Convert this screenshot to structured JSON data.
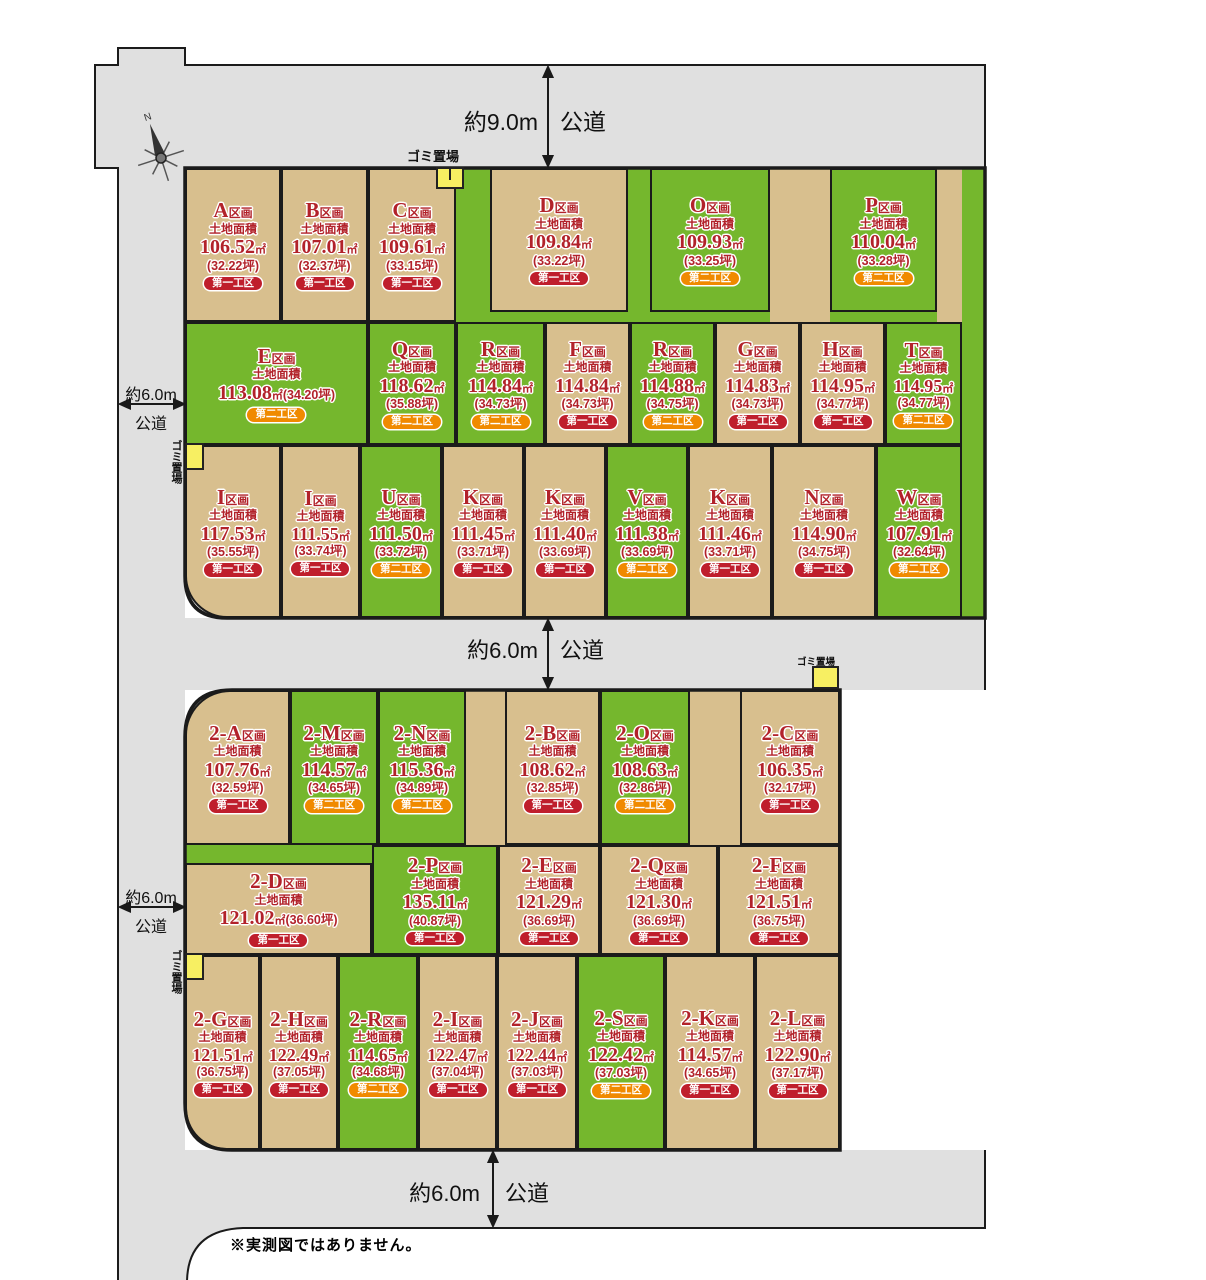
{
  "palette": {
    "tan": "#d8bf8e",
    "green": "#75b72d",
    "road_gray": "#e0e0e0",
    "border": "#1b1b1b",
    "text_red": "#b2222a",
    "badge_first_red": "#bf1e2c",
    "badge_second_orange": "#f08a00",
    "garbage_yellow": "#f7ef62"
  },
  "labels": {
    "section_suffix": "区画",
    "area_title": "土地面積",
    "sqm_unit": "㎡"
  },
  "roads": {
    "top": {
      "width_label": "約9.0m",
      "type_label": "公道"
    },
    "left_upper": {
      "width_label": "約6.0m",
      "type_label": "公道"
    },
    "middle": {
      "width_label": "約6.0m",
      "type_label": "公道"
    },
    "left_lower": {
      "width_label": "約6.0m",
      "type_label": "公道"
    },
    "bottom": {
      "width_label": "約6.0m",
      "type_label": "公道"
    }
  },
  "garbage_label": "ゴミ置場",
  "compass_label": "N",
  "note": "※実測図ではありません。",
  "badge_labels": {
    "first": "第一工区",
    "second": "第二工区"
  },
  "plots": [
    {
      "id": "A",
      "letter": "A",
      "sqm": "106.52",
      "tsubo": "(32.22坪)",
      "phase": "first",
      "color": "tan"
    },
    {
      "id": "B",
      "letter": "B",
      "sqm": "107.01",
      "tsubo": "(32.37坪)",
      "phase": "first",
      "color": "tan"
    },
    {
      "id": "C",
      "letter": "C",
      "sqm": "109.61",
      "tsubo": "(33.15坪)",
      "phase": "first",
      "color": "tan"
    },
    {
      "id": "D",
      "letter": "D",
      "sqm": "109.84",
      "tsubo": "(33.22坪)",
      "phase": "first",
      "color": "tan"
    },
    {
      "id": "O",
      "letter": "O",
      "sqm": "109.93",
      "tsubo": "(33.25坪)",
      "phase": "second",
      "color": "green"
    },
    {
      "id": "P",
      "letter": "P",
      "sqm": "110.04",
      "tsubo": "(33.28坪)",
      "phase": "second",
      "color": "green"
    },
    {
      "id": "E",
      "letter": "E",
      "sqm": "113.08",
      "tsubo": "(34.20坪)",
      "phase": "second",
      "color": "green",
      "inline": true
    },
    {
      "id": "Q",
      "letter": "Q",
      "sqm": "118.62",
      "tsubo": "(35.88坪)",
      "phase": "second",
      "color": "green"
    },
    {
      "id": "R1",
      "letter": "R",
      "sqm": "114.84",
      "tsubo": "(34.73坪)",
      "phase": "second",
      "color": "green"
    },
    {
      "id": "F",
      "letter": "F",
      "sqm": "114.84",
      "tsubo": "(34.73坪)",
      "phase": "first",
      "color": "tan"
    },
    {
      "id": "R2",
      "letter": "R",
      "sqm": "114.88",
      "tsubo": "(34.75坪)",
      "phase": "second",
      "color": "green"
    },
    {
      "id": "G",
      "letter": "G",
      "sqm": "114.83",
      "tsubo": "(34.73坪)",
      "phase": "first",
      "color": "tan"
    },
    {
      "id": "H",
      "letter": "H",
      "sqm": "114.95",
      "tsubo": "(34.77坪)",
      "phase": "first",
      "color": "tan"
    },
    {
      "id": "T",
      "letter": "T",
      "sqm": "114.95",
      "tsubo": "(34.77坪)",
      "phase": "second",
      "color": "green"
    },
    {
      "id": "I1",
      "letter": "I",
      "sqm": "117.53",
      "tsubo": "(35.55坪)",
      "phase": "first",
      "color": "tan"
    },
    {
      "id": "I2",
      "letter": "I",
      "sqm": "111.55",
      "tsubo": "(33.74坪)",
      "phase": "first",
      "color": "tan"
    },
    {
      "id": "U",
      "letter": "U",
      "sqm": "111.50",
      "tsubo": "(33.72坪)",
      "phase": "second",
      "color": "green"
    },
    {
      "id": "K1",
      "letter": "K",
      "sqm": "111.45",
      "tsubo": "(33.71坪)",
      "phase": "first",
      "color": "tan"
    },
    {
      "id": "K2",
      "letter": "K",
      "sqm": "111.40",
      "tsubo": "(33.69坪)",
      "phase": "first",
      "color": "tan"
    },
    {
      "id": "V",
      "letter": "V",
      "sqm": "111.38",
      "tsubo": "(33.69坪)",
      "phase": "second",
      "color": "green"
    },
    {
      "id": "K3",
      "letter": "K",
      "sqm": "111.46",
      "tsubo": "(33.71坪)",
      "phase": "first",
      "color": "tan"
    },
    {
      "id": "N",
      "letter": "N",
      "sqm": "114.90",
      "tsubo": "(34.75坪)",
      "phase": "first",
      "color": "tan"
    },
    {
      "id": "W",
      "letter": "W",
      "sqm": "107.91",
      "tsubo": "(32.64坪)",
      "phase": "second",
      "color": "green"
    },
    {
      "id": "2A",
      "letter": "2-A",
      "sqm": "107.76",
      "tsubo": "(32.59坪)",
      "phase": "first",
      "color": "tan"
    },
    {
      "id": "2M",
      "letter": "2-M",
      "sqm": "114.57",
      "tsubo": "(34.65坪)",
      "phase": "second",
      "color": "green"
    },
    {
      "id": "2N",
      "letter": "2-N",
      "sqm": "115.36",
      "tsubo": "(34.89坪)",
      "phase": "second",
      "color": "green"
    },
    {
      "id": "2B",
      "letter": "2-B",
      "sqm": "108.62",
      "tsubo": "(32.85坪)",
      "phase": "first",
      "color": "tan"
    },
    {
      "id": "2O",
      "letter": "2-O",
      "sqm": "108.63",
      "tsubo": "(32.86坪)",
      "phase": "second",
      "color": "green"
    },
    {
      "id": "2C",
      "letter": "2-C",
      "sqm": "106.35",
      "tsubo": "(32.17坪)",
      "phase": "first",
      "color": "tan"
    },
    {
      "id": "2D",
      "letter": "2-D",
      "sqm": "121.02",
      "tsubo": "(36.60坪)",
      "phase": "first",
      "color": "tan",
      "inline": true
    },
    {
      "id": "2P",
      "letter": "2-P",
      "sqm": "135.11",
      "tsubo": "(40.87坪)",
      "phase": "first",
      "color": "green"
    },
    {
      "id": "2E",
      "letter": "2-E",
      "sqm": "121.29",
      "tsubo": "(36.69坪)",
      "phase": "first",
      "color": "tan"
    },
    {
      "id": "2Q",
      "letter": "2-Q",
      "sqm": "121.30",
      "tsubo": "(36.69坪)",
      "phase": "first",
      "color": "tan"
    },
    {
      "id": "2F",
      "letter": "2-F",
      "sqm": "121.51",
      "tsubo": "(36.75坪)",
      "phase": "first",
      "color": "tan"
    },
    {
      "id": "2G",
      "letter": "2-G",
      "sqm": "121.51",
      "tsubo": "(36.75坪)",
      "phase": "first",
      "color": "tan"
    },
    {
      "id": "2H",
      "letter": "2-H",
      "sqm": "122.49",
      "tsubo": "(37.05坪)",
      "phase": "first",
      "color": "tan"
    },
    {
      "id": "2R",
      "letter": "2-R",
      "sqm": "114.65",
      "tsubo": "(34.68坪)",
      "phase": "second",
      "color": "green"
    },
    {
      "id": "2I",
      "letter": "2-I",
      "sqm": "122.47",
      "tsubo": "(37.04坪)",
      "phase": "first",
      "color": "tan"
    },
    {
      "id": "2J",
      "letter": "2-J",
      "sqm": "122.44",
      "tsubo": "(37.03坪)",
      "phase": "first",
      "color": "tan"
    },
    {
      "id": "2S",
      "letter": "2-S",
      "sqm": "122.42",
      "tsubo": "(37.03坪)",
      "phase": "second",
      "color": "green"
    },
    {
      "id": "2K",
      "letter": "2-K",
      "sqm": "114.57",
      "tsubo": "(34.65坪)",
      "phase": "first",
      "color": "tan"
    },
    {
      "id": "2L",
      "letter": "2-L",
      "sqm": "122.90",
      "tsubo": "(37.17坪)",
      "phase": "first",
      "color": "tan"
    }
  ]
}
